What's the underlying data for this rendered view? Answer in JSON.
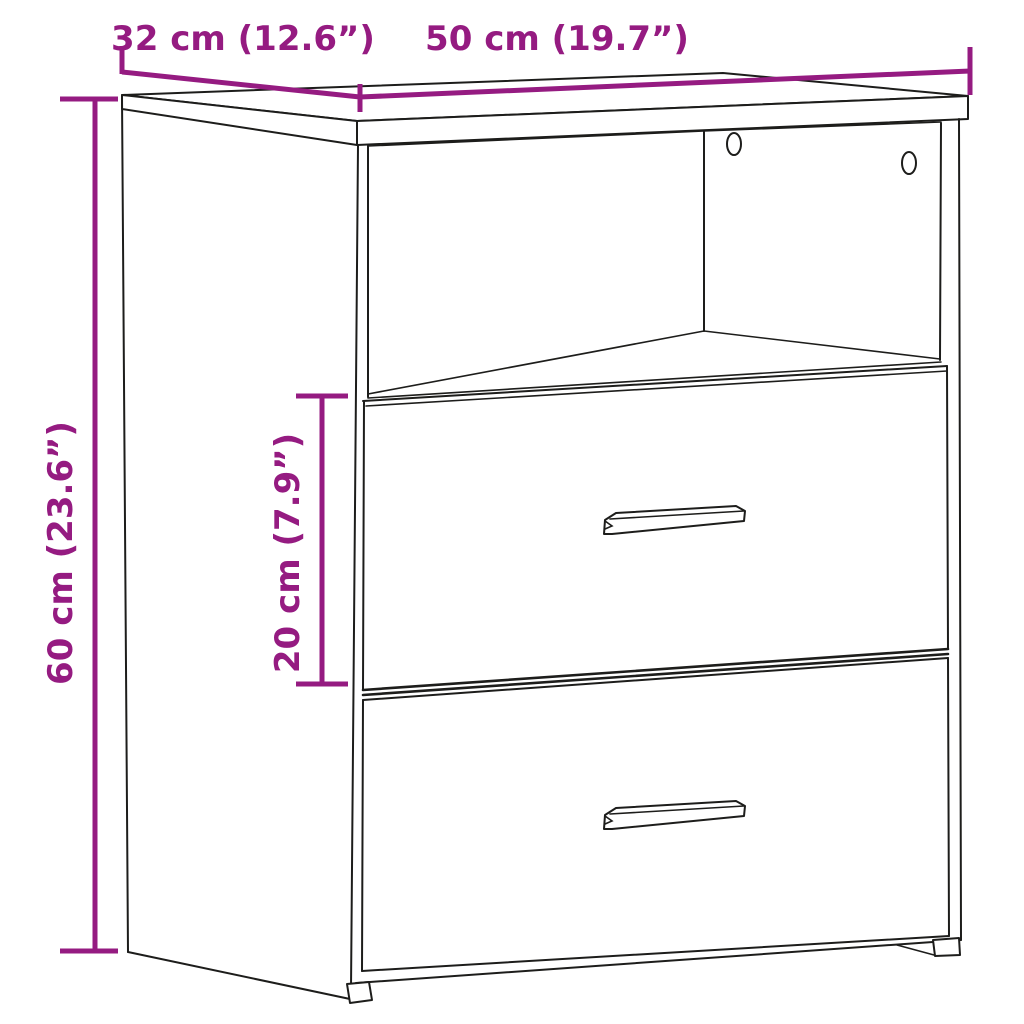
{
  "figure": {
    "title": "Bedside cabinet dimension diagram",
    "dimensions": {
      "depth": {
        "label": "32 cm (12.6”)",
        "value_cm": 32,
        "value_in": 12.6
      },
      "width": {
        "label": "50 cm (19.7”)",
        "value_cm": 50,
        "value_in": 19.7
      },
      "height": {
        "label": "60 cm (23.6”)",
        "value_cm": 60,
        "value_in": 23.6
      },
      "drawer_height": {
        "label": "20 cm (7.9”)",
        "value_cm": 20,
        "value_in": 7.9
      }
    },
    "colors": {
      "dimension": "#951B81",
      "line": "#1D1D1B",
      "background": "#FFFFFF"
    }
  }
}
